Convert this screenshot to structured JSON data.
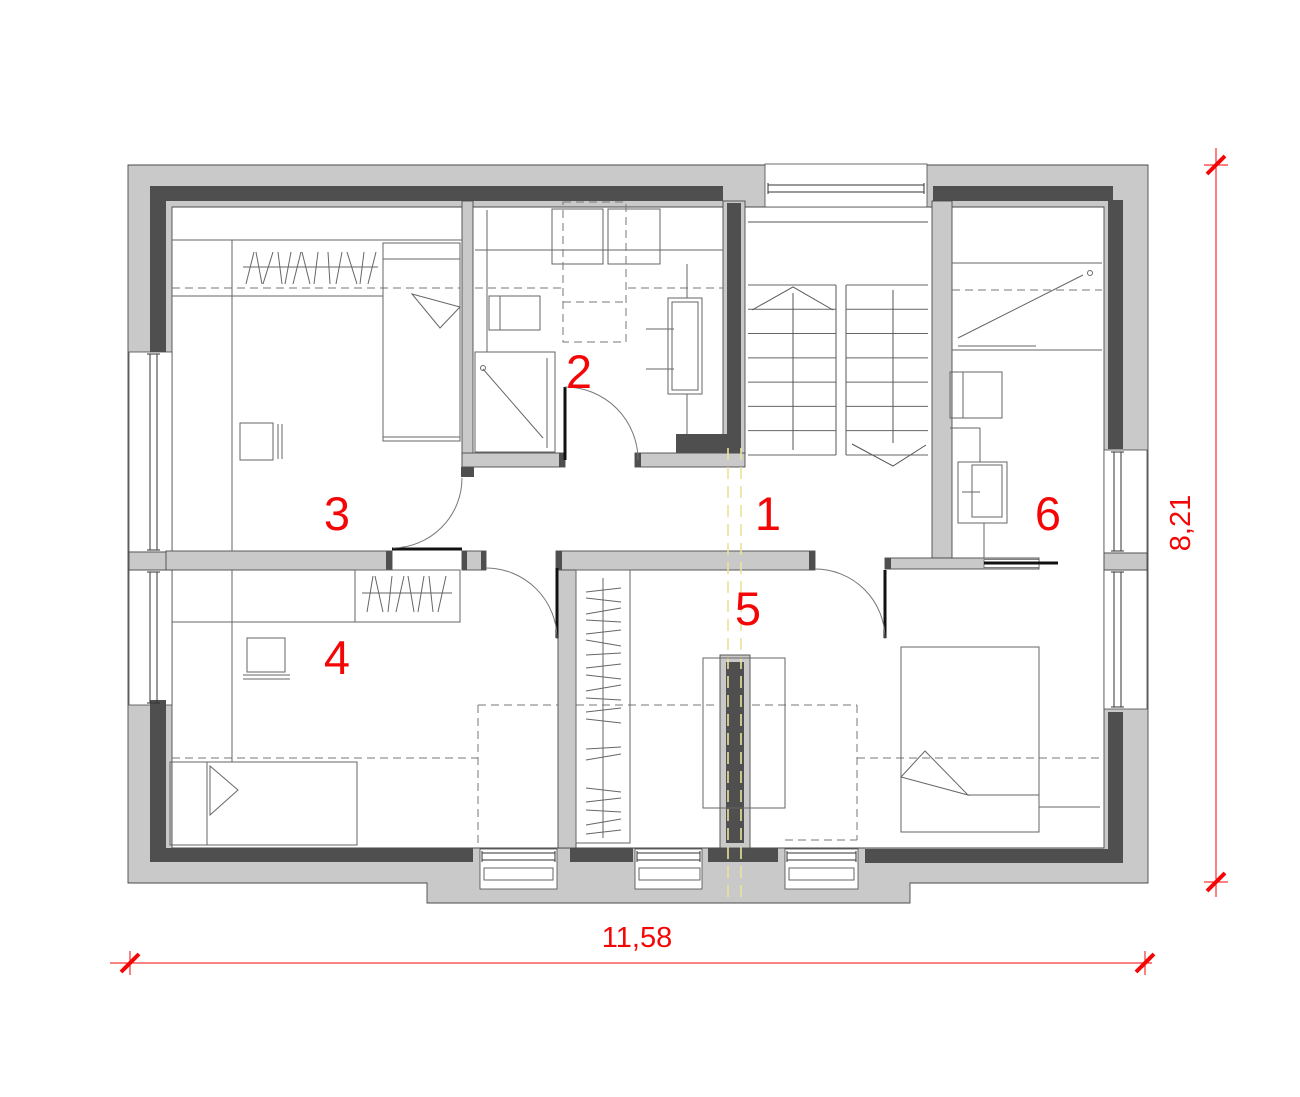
{
  "drawing": {
    "type_label": "floor plan",
    "room_labels": [
      "1",
      "2",
      "3",
      "4",
      "5",
      "6"
    ],
    "dimensions": {
      "width": "11,58",
      "height": "8,21"
    },
    "colors": {
      "dimension_red": "#f40606",
      "section_line_yellow": "#e9e39b",
      "wall_gray": "#c9c9c9",
      "wall_dark": "#4f4f4f"
    }
  }
}
